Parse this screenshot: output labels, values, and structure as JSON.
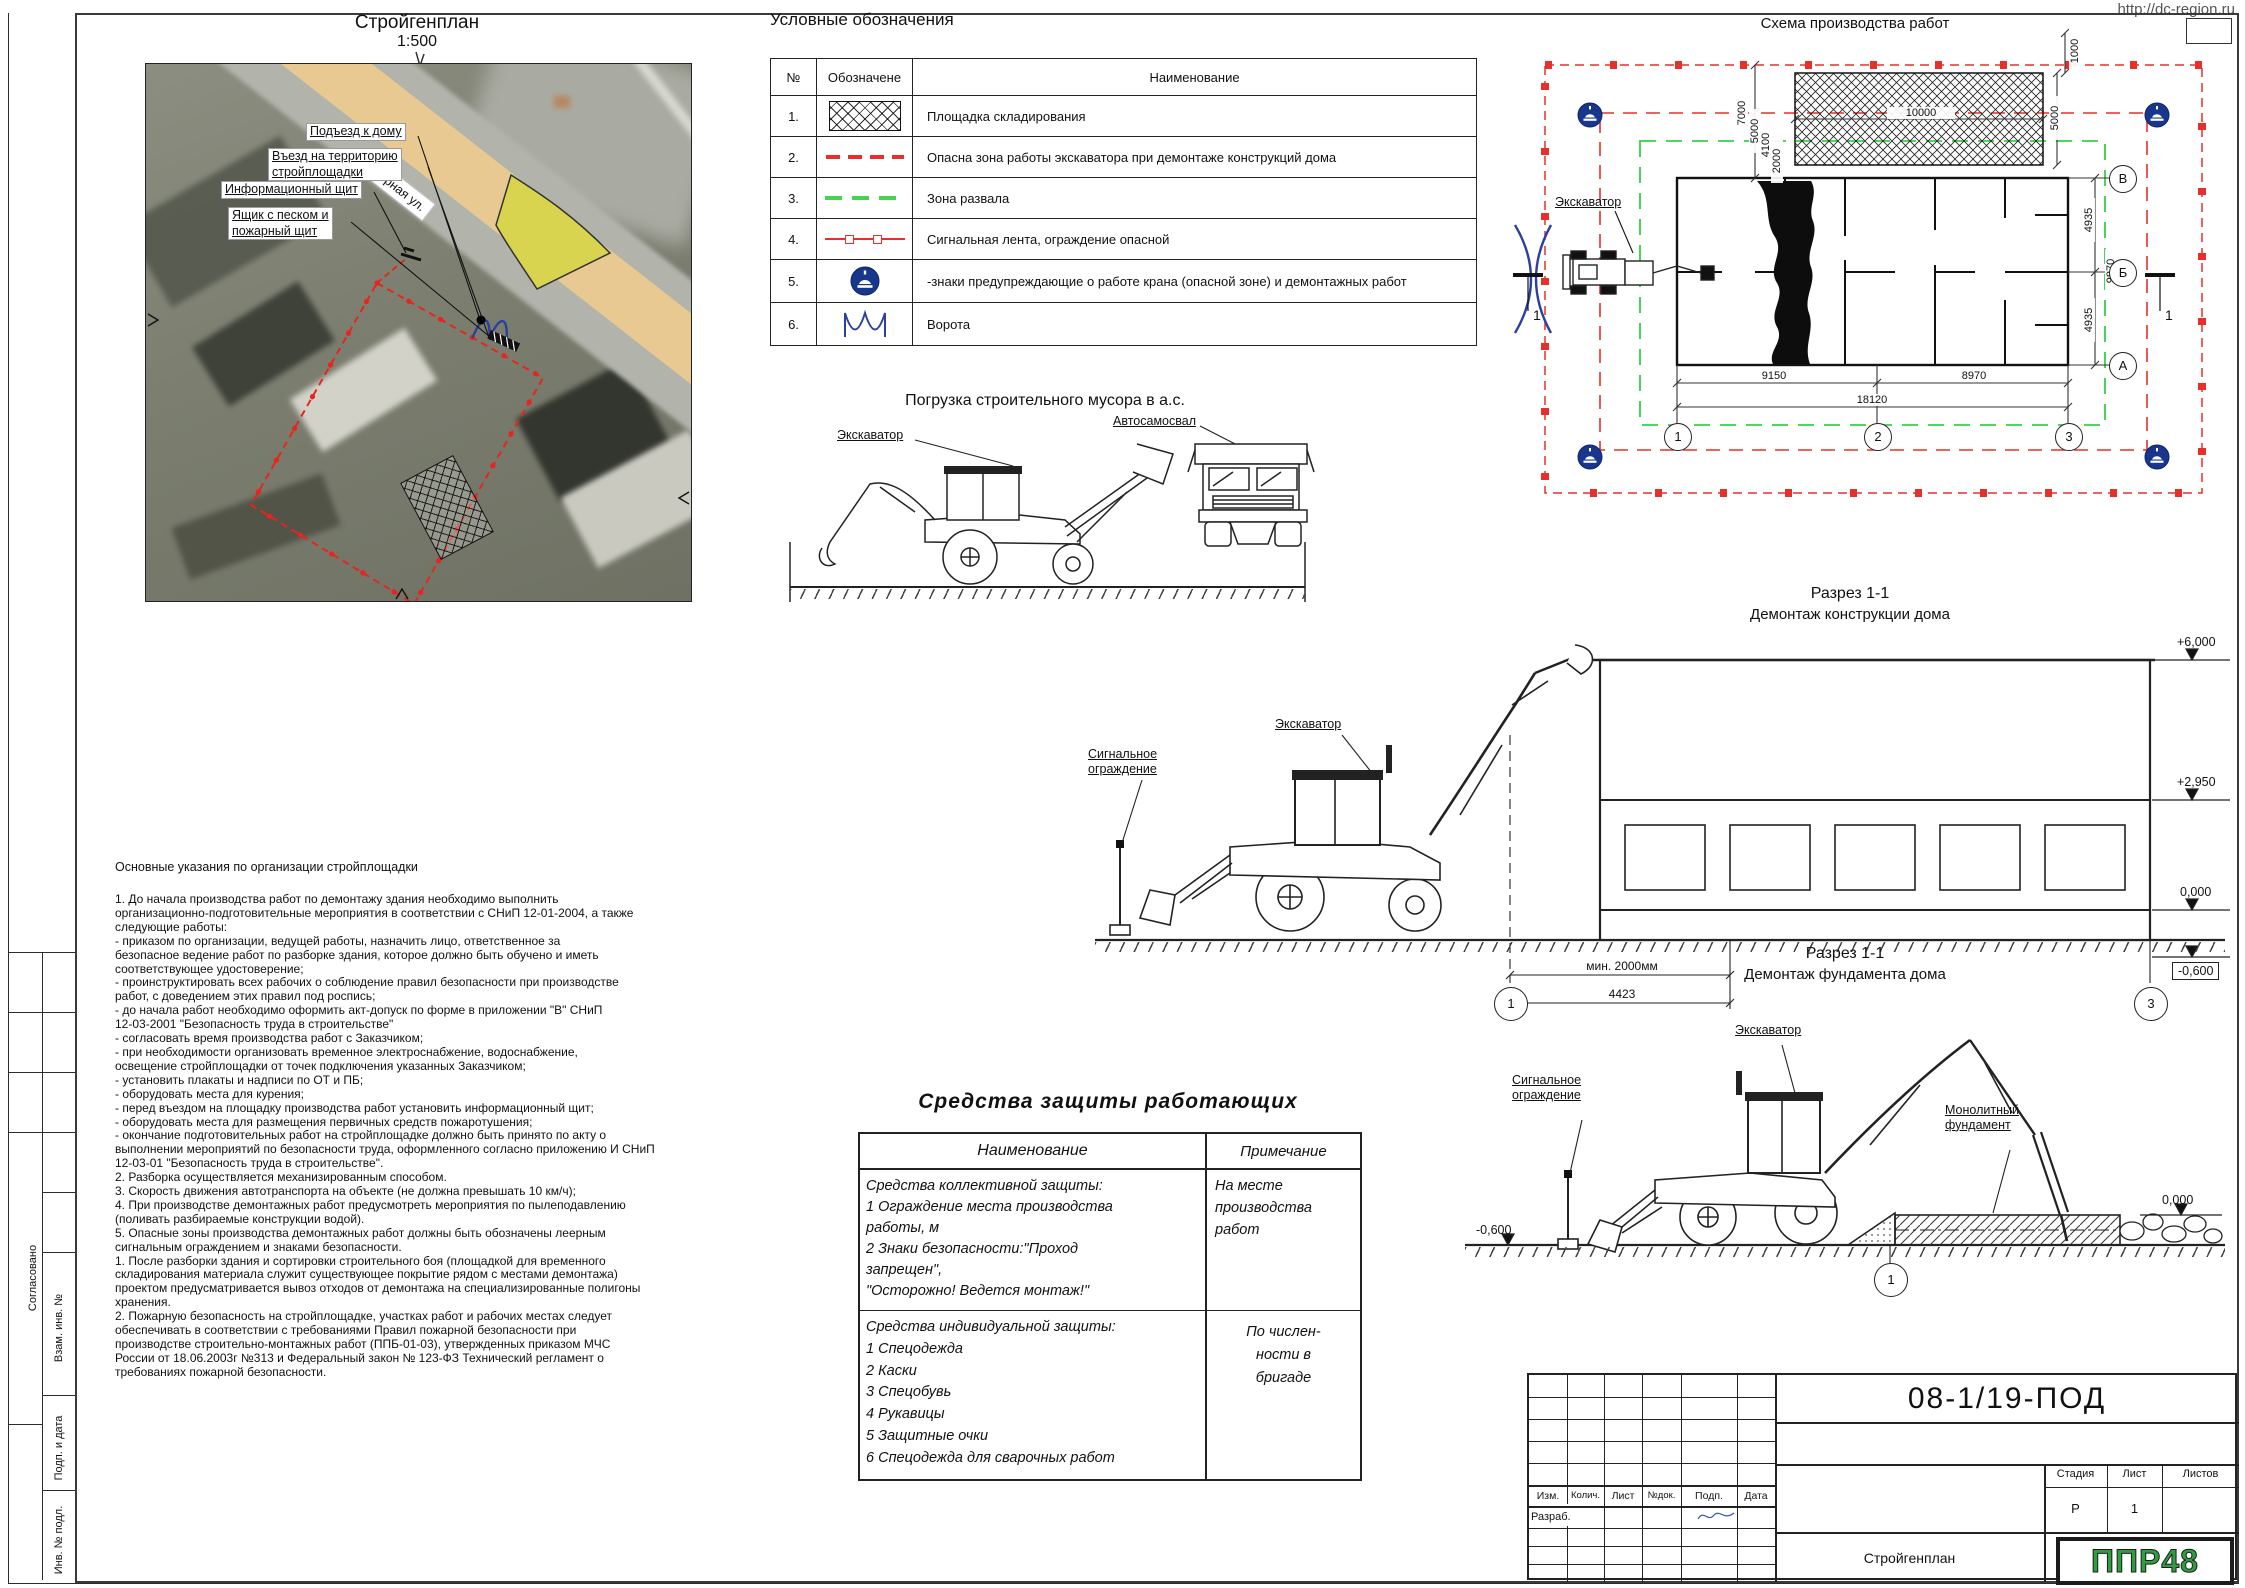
{
  "page": {
    "url": "http://dc-region.ru",
    "format": "А2"
  },
  "frame": {
    "approved": "Согласовано",
    "vzam": "Взам. инв. №",
    "podpdate": "Подп. и дата",
    "invnum": "Инв. № подл."
  },
  "siteplan": {
    "title": "Стройгенплан",
    "scale": "1:500",
    "street": "Озерная ул.",
    "driveway": "Подъезд к дому",
    "entrance": "Въезд на территорию\nстройплощадки",
    "infoboard": "Информационный щит",
    "sandbox": "Ящик с песком и\nпожарный щит"
  },
  "legend": {
    "title": "Условные обозначения",
    "col_num": "№",
    "col_sym": "Обозначене",
    "col_name": "Наименование",
    "rows": [
      {
        "num": "1.",
        "name": "Площадка складирования"
      },
      {
        "num": "2.",
        "name": "Опасна зона работы экскаватора при демонтаже конструкций дома"
      },
      {
        "num": "3.",
        "name": "Зона развала"
      },
      {
        "num": "4.",
        "name": "Сигнальная лента, ограждение опасной"
      },
      {
        "num": "5.",
        "name": "-знаки предупреждающие о работе крана (опасной зоне) и демонтажных работ"
      },
      {
        "num": "6.",
        "name": "Ворота"
      }
    ]
  },
  "scheme": {
    "title": "Схема производства работ",
    "excavator": "Экскаватор",
    "mark": "1",
    "dims": {
      "v7000": "7000",
      "v5000": "5000",
      "v4100": "4100",
      "v2000": "2000",
      "top10000": "10000",
      "right5000": "5000",
      "corner1000": "1000",
      "b9150": "9150",
      "b8970": "8970",
      "b18120": "18120",
      "r4935a": "4935",
      "r9870": "9870",
      "r4935b": "4935"
    },
    "axes": {
      "v": "В",
      "b": "Б",
      "a": "А",
      "n1": "1",
      "n2": "2",
      "n3": "3"
    }
  },
  "loading": {
    "title": "Погрузка строительного мусора в а.с.",
    "excavator": "Экскаватор",
    "truck": "Автосамосвал"
  },
  "sec1": {
    "t1": "Разрез 1-1",
    "t2": "Демонтаж конструкции дома",
    "excavator": "Экскаватор",
    "fence": "Сигнальное\nограждение",
    "e6000": "+6,000",
    "e2950": "+2,950",
    "e0": "0,000",
    "em600": "-0,600",
    "dmin": "мин. 2000мм",
    "d4423": "4423",
    "ax1": "1",
    "ax3": "3"
  },
  "sec2": {
    "t1": "Разрез 1-1",
    "t2": "Демонтаж фундамента дома",
    "excavator": "Экскаватор",
    "fence": "Сигнальное\nограждение",
    "foundation": "Монолитный\nфундамент",
    "e0": "0,000",
    "em600": "-0,600",
    "ax1": "1"
  },
  "notes": {
    "title": "Основные указания по организации стройплощадки",
    "body": "1.  До начала производства работ по демонтажу здания необходимо выполнить\nорганизационно-подготовительные мероприятия в соответствии с СНиП 12-01-2004, а также\nследующие работы:\n-       приказом по организации, ведущей работы, назначить лицо, ответственное за\nбезопасное ведение работ по разборке здания, которое должно быть обучено и иметь\nсоответствующее удостоверение;\n-       проинструктировать всех рабочих о соблюдение правил безопасности при производстве\nработ, с доведением этих правил под роспись;\n-       до начала работ необходимо оформить акт-допуск по форме в приложении \"В\" СНиП\n12-03-2001 \"Безопасность труда в строительстве\"\n-       согласовать время производства работ с Заказчиком;\n-       при необходимости организовать временное электроснабжение, водоснабжение,\nосвещение стройплощадки от точек подключения указанных Заказчиком;\n-       установить плакаты и надписи по ОТ и ПБ;\n-       оборудовать места для курения;\n-       перед въездом на площадку производства работ установить информационный щит;\n-       оборудовать места для размещения первичных средств пожаротушения;\n-       окончание подготовительных работ на стройплощадке должно быть принято по акту о\nвыполнении мероприятий по безопасности труда, оформленного согласно приложению И СНиП\n12-03-01 \"Безопасность труда в строительстве\".\n2. Разборка осуществляется механизированным способом.\n3. Скорость движения автотранспорта на объекте (не должна превышать 10 км/ч);\n4.  При производстве демонтажных работ предусмотреть мероприятия по пылеподавлению\n(поливать разбираемые конструкции водой).\n5. Опасные зоны производства демонтажных работ должны быть обозначены леерным\nсигнальным ограждением и знаками безопасности.\n1.      После разборки здания и сортировки строительного боя  (площадкой для временного\nскладирования материала служит существующее покрытие рядом с местами демонтажа)\nпроектом предусматривается вывоз отходов от демонтажа на специализированные полигоны\nхранения.\n2.      Пожарную безопасность на стройплощадке, участках работ и рабочих местах следует\nобеспечивать в соответствии с требованиями Правил пожарной безопасности при\nпроизводстве строительно-монтажных работ (ППБ-01-03), утвержденных приказом МЧС\nРоссии от 18.06.2003г №313 и Федеральный закон № 123-ФЗ Технический регламент о\nтребованиях пожарной безопасности."
  },
  "ppe": {
    "title": "Средства защиты работающих",
    "col_name": "Наименование",
    "col_note": "Примечание",
    "r1name": "Средства коллективной защиты:\n1 Ограждение места производства\nработы, м\n2 Знаки безопасности:\"Проход\nзапрещен\",\n\"Осторожно! Ведется монтаж!\"",
    "r1note": "На месте\nпроизводства\nработ",
    "r2name": "Средства индивидуальной защиты:\n1 Спецодежда\n2 Каски\n3 Спецобувь\n4 Рукавицы\n5 Защитные очки\n6 Спецодежда для сварочных работ",
    "r2note": "По числен-\nности в\nбригаде"
  },
  "tb": {
    "doc": "08-1/19-ПОД",
    "izm": "Изм.",
    "kol": "Колич.",
    "list": "Лист",
    "ndok": "№док.",
    "podp": "Подп.",
    "data": "Дата",
    "razrab": "Разраб.",
    "stadia": "Стадия",
    "list2": "Лист",
    "listov": "Листов",
    "stadia_v": "Р",
    "list_v": "1",
    "title": "Стройгенплан",
    "logo": "ППР48"
  }
}
